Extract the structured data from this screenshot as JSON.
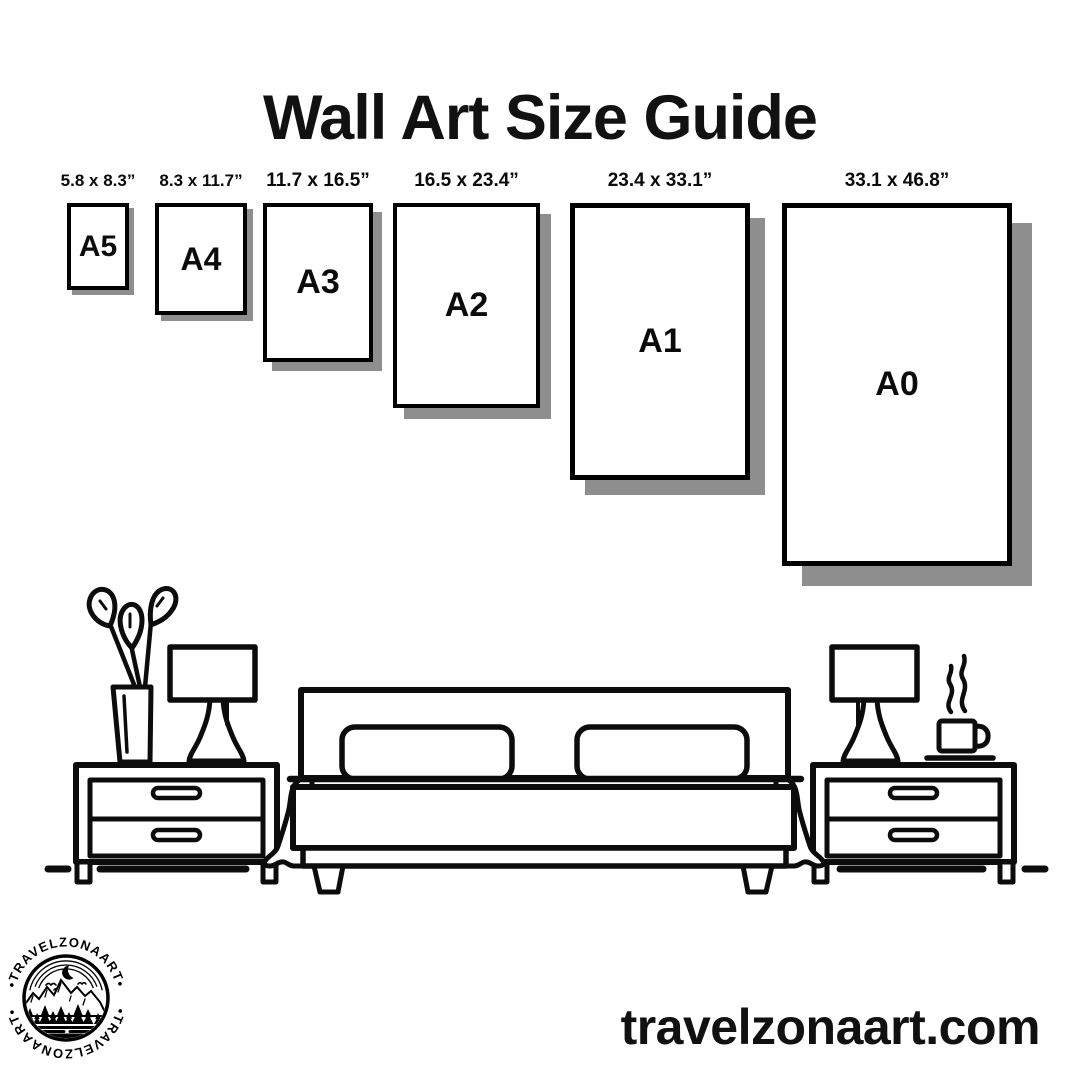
{
  "page": {
    "title": "Wall Art Size Guide",
    "background_color": "#ffffff",
    "text_color": "#0b0b0b"
  },
  "size_guide": {
    "frame_fill": "#ffffff",
    "frame_border_color": "#000000",
    "shadow_color": "#8e8e8e",
    "items": [
      {
        "code": "A5",
        "dimensions": "5.8 x 8.3”"
      },
      {
        "code": "A4",
        "dimensions": "8.3 x 11.7”"
      },
      {
        "code": "A3",
        "dimensions": "11.7 x 16.5”"
      },
      {
        "code": "A2",
        "dimensions": "16.5 x 23.4”"
      },
      {
        "code": "A1",
        "dimensions": "23.4 x 33.1”"
      },
      {
        "code": "A0",
        "dimensions": "33.1 x 46.8”"
      }
    ]
  },
  "illustration": {
    "scene": "bedroom-line-art",
    "line_color": "#0c0c0c",
    "elements": [
      "potted-plant",
      "left-table-lamp",
      "left-nightstand",
      "double-bed",
      "pillow",
      "pillow",
      "right-table-lamp",
      "coffee-cup",
      "right-nightstand",
      "floor-line"
    ]
  },
  "branding": {
    "logo_arc_text_top": "•TRAVELZONAART•",
    "logo_arc_text_bottom": "•TRAVELZONAART•",
    "website": "travelzonaart.com"
  }
}
